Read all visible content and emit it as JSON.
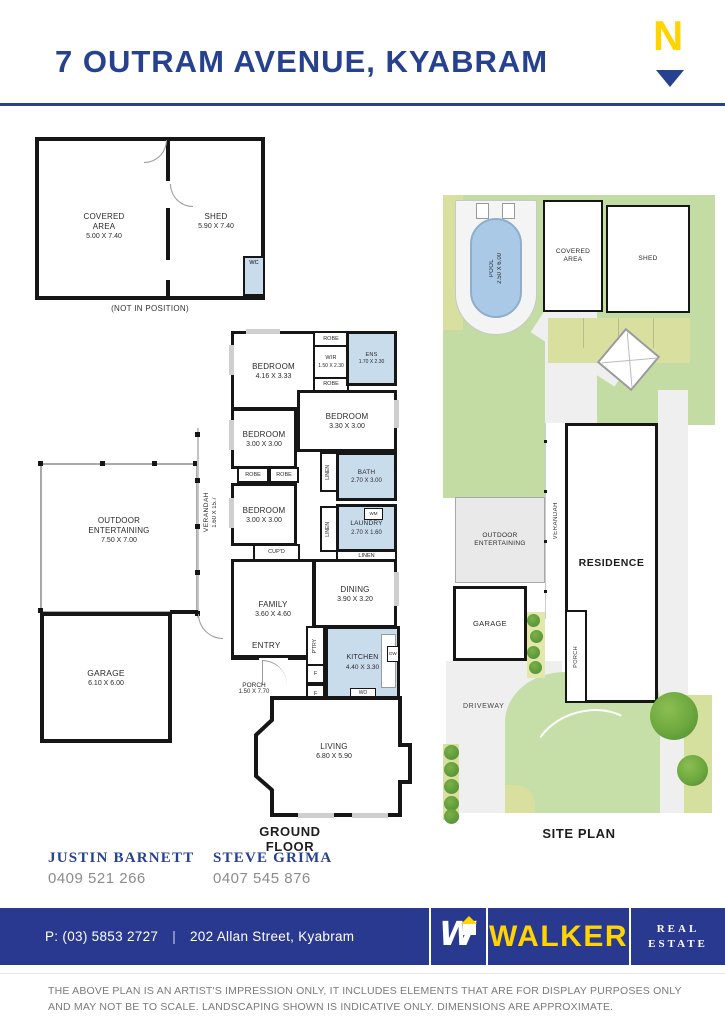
{
  "header": {
    "title": "7 OUTRAM AVENUE, KYABRAM",
    "compass": "N"
  },
  "floorplan": {
    "caption": "GROUND FLOOR",
    "not_in_position": "(NOT IN POSITION)",
    "rooms": {
      "covered_area": {
        "name": "COVERED AREA",
        "dims": "5.00 X 7.40"
      },
      "shed": {
        "name": "SHED",
        "dims": "5.90 X 7.40"
      },
      "wc": {
        "name": "WC"
      },
      "bedroom_main": {
        "name": "BEDROOM",
        "dims": "4.16 X 3.33"
      },
      "wir": {
        "name": "WIR",
        "dims": "1.50 X 2.30"
      },
      "ens": {
        "name": "ENS",
        "dims": "1.70 X 2.30"
      },
      "bedroom2": {
        "name": "BEDROOM",
        "dims": "3.30 X 3.00"
      },
      "bedroom3": {
        "name": "BEDROOM",
        "dims": "3.00 X 3.00"
      },
      "bedroom4": {
        "name": "BEDROOM",
        "dims": "3.00 X 3.00"
      },
      "bath": {
        "name": "BATH",
        "dims": "2.70 X 3.00"
      },
      "laundry": {
        "name": "LAUNDRY",
        "dims": "2.70 X 1.60"
      },
      "family": {
        "name": "FAMILY",
        "dims": "3.60 X 4.60"
      },
      "dining": {
        "name": "DINING",
        "dims": "3.90 X 3.20"
      },
      "kitchen": {
        "name": "KITCHEN",
        "dims": "4.40 X 3.30"
      },
      "living": {
        "name": "LIVING",
        "dims": "6.80 X 5.90"
      },
      "entry": {
        "name": "ENTRY"
      },
      "porch": {
        "name": "PORCH",
        "dims": "1.50 X 7.70"
      },
      "garage": {
        "name": "GARAGE",
        "dims": "6.10 X 6.00"
      },
      "outdoor": {
        "name": "OUTDOOR ENTERTAINING",
        "dims": "7.50 X 7.00"
      },
      "verandah": {
        "name": "VERANDAH",
        "dims": "1.60 X 15.7"
      }
    },
    "small": {
      "robe": "ROBE",
      "linen": "LINEN",
      "cupd": "CUP'D",
      "ptry": "P'TRY",
      "wm": "WM",
      "f": "F",
      "wo": "WO",
      "dw": "DW"
    }
  },
  "siteplan": {
    "caption": "SITE PLAN",
    "labels": {
      "pool": {
        "name": "POOL",
        "dims": "2.50 X 6.00"
      },
      "covered_area": "COVERED AREA",
      "shed": "SHED",
      "outdoor": "OUTDOOR ENTERTAINING",
      "verandah": "VERANDAH",
      "residence": "RESIDENCE",
      "porch": "PORCH",
      "garage": "GARAGE",
      "driveway": "DRIVEWAY"
    }
  },
  "agents": [
    {
      "name": "JUSTIN BARNETT",
      "phone": "0409 521 266"
    },
    {
      "name": "STEVE GRIMA",
      "phone": "0407 545 876"
    }
  ],
  "footer": {
    "phone": "P: (03) 5853 2727",
    "divider": "|",
    "address": "202 Allan Street, Kyabram",
    "brand_mark": "W",
    "brand": "WALKER",
    "real": "REAL",
    "estate": "ESTATE"
  },
  "disclaimer": {
    "line1": "THE ABOVE PLAN IS AN ARTIST'S IMPRESSION ONLY, IT INCLUDES ELEMENTS THAT ARE FOR DISPLAY PURPOSES ONLY",
    "line2": "AND MAY NOT BE TO SCALE. LANDSCAPING SHOWN IS INDICATIVE ONLY. DIMENSIONS ARE APPROXIMATE."
  },
  "colors": {
    "accent_blue": "#26418F",
    "footer_navy": "#2A3990",
    "brand_yellow": "#FFD400",
    "wet_area": "#C9DCEC",
    "lawn_green": "#C3DCA4",
    "garden_yellow": "#D9DF9E",
    "wall": "#161616"
  }
}
